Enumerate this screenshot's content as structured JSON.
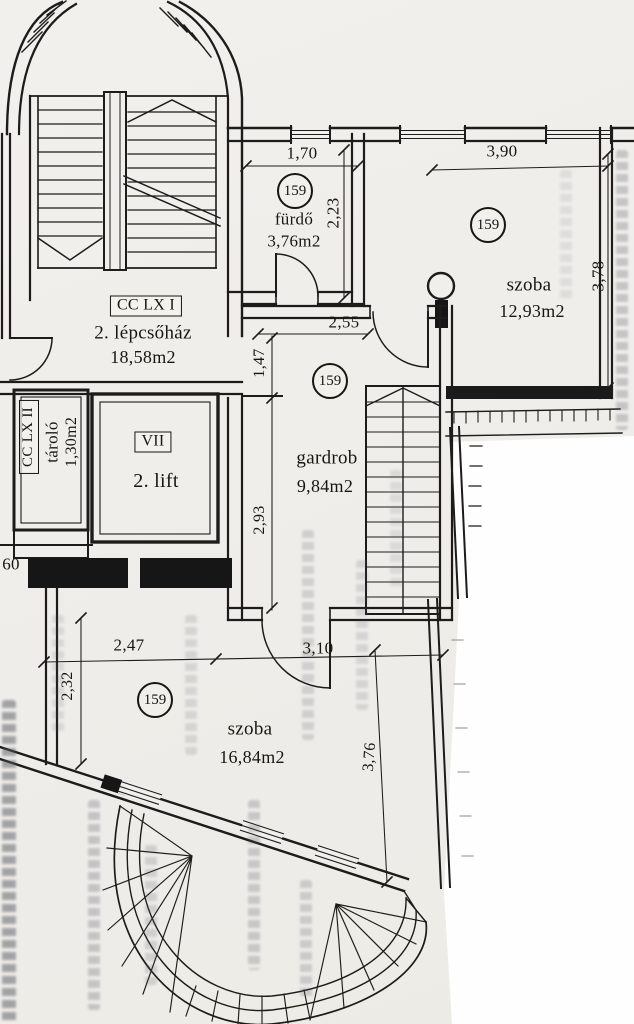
{
  "plan": {
    "unit_number": "159",
    "rooms": {
      "lepcsohaz": {
        "code": "CC LX I",
        "name": "2. lépcsőház",
        "area": "18,58m2"
      },
      "tarolo": {
        "code": "CC LX II",
        "name": "tároló",
        "area": "1,30m2"
      },
      "lift": {
        "code": "VII",
        "name": "2. lift"
      },
      "furdo": {
        "name": "fürdő",
        "area": "3,76m2"
      },
      "szoba_felso": {
        "name": "szoba",
        "area": "12,93m2"
      },
      "gardrob": {
        "name": "gardrob",
        "area": "9,84m2"
      },
      "szoba_also": {
        "name": "szoba",
        "area": "16,84m2"
      }
    },
    "dimensions": {
      "furdo_szelesseg": "1,70",
      "furdo_melyseg": "2,23",
      "szoba_felso_szelesseg": "3,90",
      "szoba_felso_melyseg": "3,78",
      "gardrob_szelesseg": "2,55",
      "gardrob_felso": "1,47",
      "gardrob_also": "2,93",
      "bal_oldal": "60",
      "szoba_also_bal": "2,47",
      "szoba_also_bal_melyseg": "2,32",
      "szoba_also_jobb": "3,10",
      "szoba_also_jobb_melyseg": "3,76"
    }
  }
}
